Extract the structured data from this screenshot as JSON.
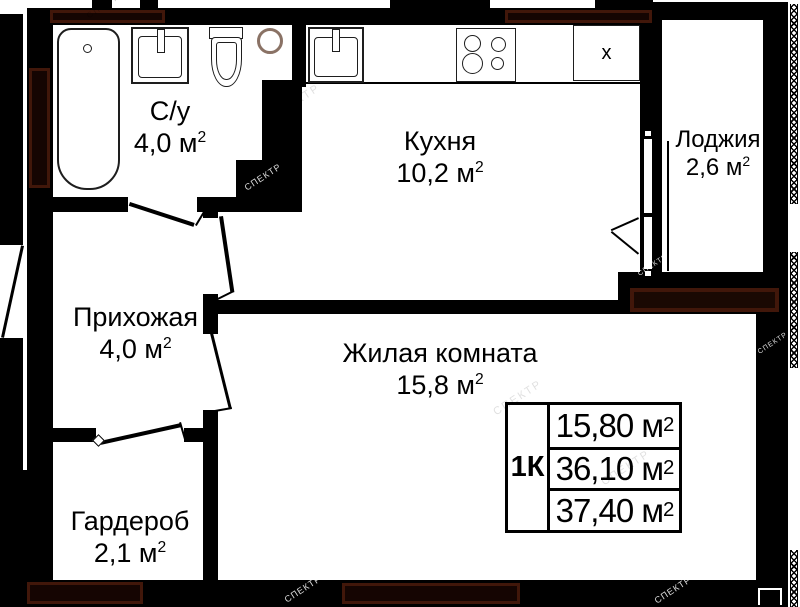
{
  "watermark": "СПЕКТР",
  "rooms": {
    "bathroom": {
      "name": "С/у",
      "area": "4,0 м",
      "sup": "2"
    },
    "kitchen": {
      "name": "Кухня",
      "area": "10,2 м",
      "sup": "2"
    },
    "loggia": {
      "name": "Лоджия",
      "area": "2,6 м",
      "sup": "2"
    },
    "hallway": {
      "name": "Прихожая",
      "area": "4,0 м",
      "sup": "2"
    },
    "living": {
      "name": "Жилая комната",
      "area": "15,8 м",
      "sup": "2"
    },
    "wardrobe": {
      "name": "Гардероб",
      "area": "2,1 м",
      "sup": "2"
    }
  },
  "summary_table": {
    "apartment_type": "1К",
    "rows": [
      {
        "value": "15,80 м",
        "sup": "2"
      },
      {
        "value": "36,10 м",
        "sup": "2"
      },
      {
        "value": "37,40 м",
        "sup": "2"
      }
    ]
  },
  "kitchen_marks": {
    "fridge": "x"
  },
  "colors": {
    "wall": "#000000",
    "hatch_border": "#41170a",
    "paper": "#ffffff"
  }
}
